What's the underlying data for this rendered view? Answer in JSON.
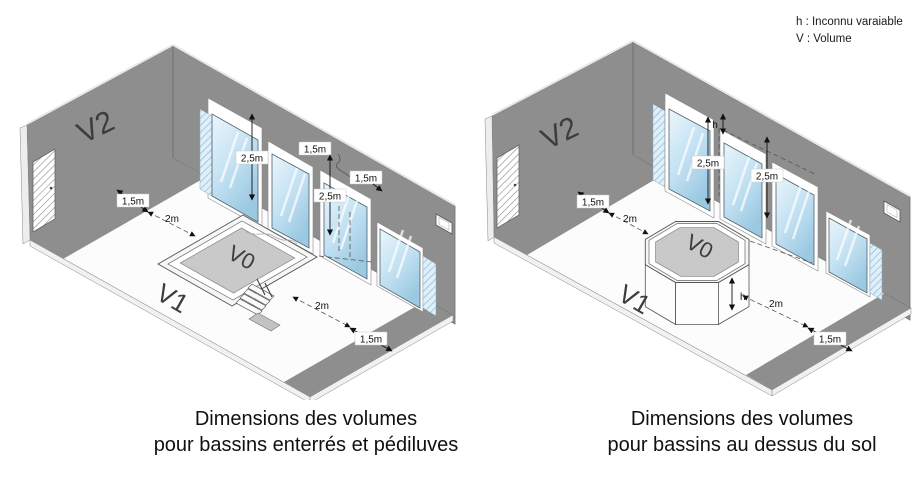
{
  "legend": {
    "line1": "h : Inconnu varaiable",
    "line2": "V : Volume"
  },
  "left": {
    "caption1": "Dimensions des volumes",
    "caption2": "pour bassins enterrés et pédiluves",
    "labels": {
      "wall": "V2",
      "floor": "V1",
      "pool": "V0"
    },
    "dims": {
      "win1": "2,5m",
      "top1": "1,5m",
      "top2": "1,5m",
      "win3": "2,5m",
      "wall_strip": "1,5m",
      "to_pool": "2m",
      "from_pool": "2m",
      "front_strip": "1,5m"
    }
  },
  "right": {
    "caption1": "Dimensions des volumes",
    "caption2": "pour bassins au dessus du sol",
    "labels": {
      "wall": "V2",
      "floor": "V1",
      "pool": "V0"
    },
    "dims": {
      "win1": "2,5m",
      "win2": "2,5m",
      "h_top": "h",
      "h_pool": "h",
      "wall_strip": "1,5m",
      "to_pool": "2m",
      "from_pool": "2m",
      "front_strip": "1,5m"
    }
  },
  "colors": {
    "wall_gray": "#8e8e8e",
    "water_gray": "#c9c9c9",
    "glass_blue": "#bfe0f2",
    "background": "#ffffff"
  }
}
